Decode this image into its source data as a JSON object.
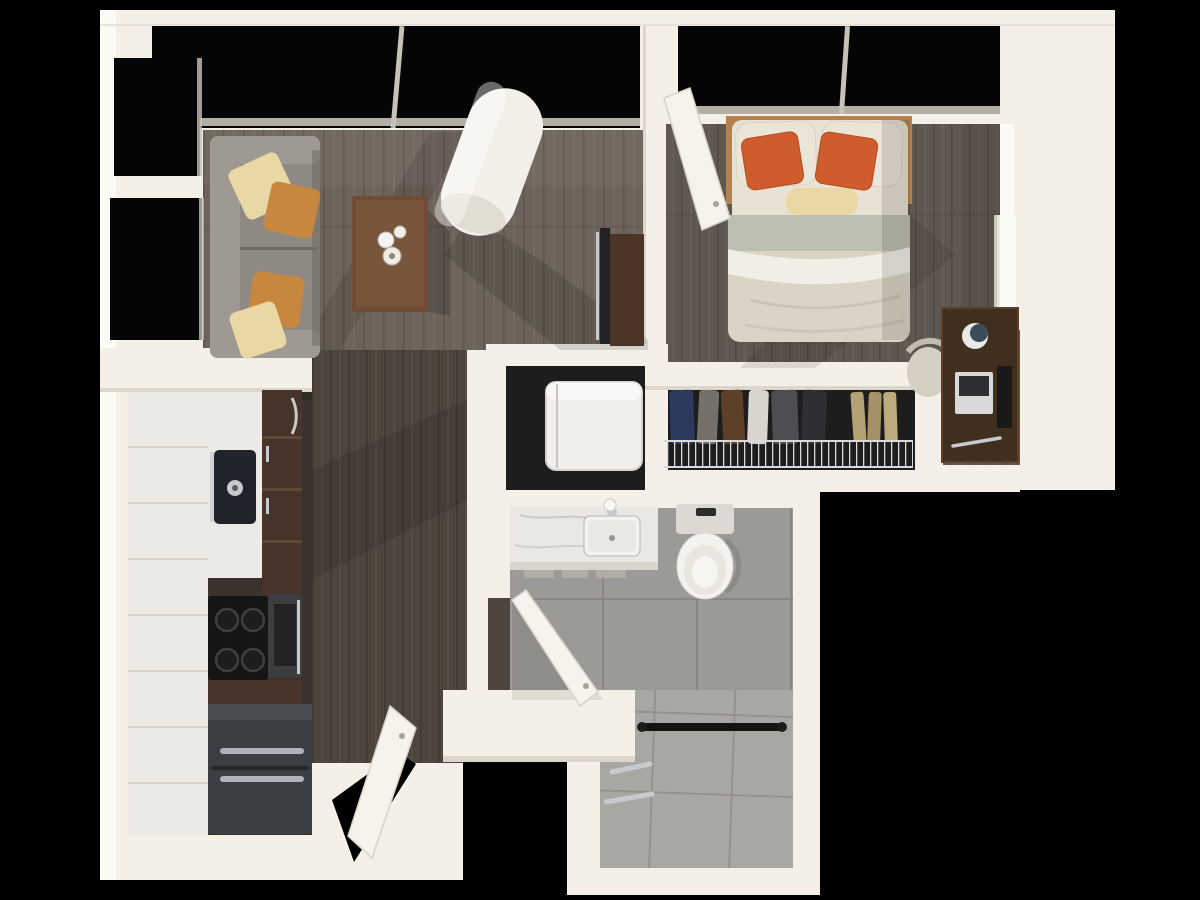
{
  "scene": {
    "width": 1200,
    "height": 900,
    "view": "top-down-3d-floor-plan"
  },
  "palette": {
    "bg": "#000000",
    "wall": "#f4f0e8",
    "wall_bright": "#fcfaf5",
    "wall_shade": "#ddd7cb",
    "frame_gray": "#c7c2b8",
    "glass": "#050505",
    "floor_living": "#6e635a",
    "floor_bedroom": "#5f5850",
    "floor_hall": "#4d443c",
    "floor_kitchen": "#3a332d",
    "tile_bath": "#9c9a96",
    "grout_bath": "#8a8781",
    "tile_shower": "#a9a7a2",
    "grout_shower": "#95928b",
    "counter": "#eceae4",
    "counter_seam": "#d5d1c7",
    "sofa": "#8e8982",
    "sofa_light": "#9e9992",
    "sofa_dark": "#6f6a63",
    "pillow_cream": "#e9d8a5",
    "pillow_tan": "#c8873f",
    "pillow_white": "#eae5d7",
    "pillow_orange": "#ce5c2c",
    "table_wood": "#6f4c33",
    "table_wood_light": "#836041",
    "column": "#f3f0e9",
    "column_shade": "#d9d4c9",
    "tv_console": "#4a3526",
    "tv_screen": "#222226",
    "bed_frame": "#b3824f",
    "bed_linen": "#e7e2d3",
    "bed_duvet": "#d9d4c4",
    "bed_sage": "#bcc0b0",
    "bed_white": "#f1eee5",
    "desk_wood": "#402e1f",
    "desk_edge": "#5a4128",
    "chair": "#d6d0c2",
    "laptop_body": "#d9d9d9",
    "laptop_screen": "#2d2f33",
    "closet_dark": "#1d1d1d",
    "wire": "#d9d9d9",
    "washer": "#f0efeb",
    "marble": "#eae8e3",
    "fixture": "#f3f2ee",
    "fixture_shade": "#dbd9d1",
    "towel": "#141414",
    "chrome": "#c6cacd",
    "cabinet": "#46342a",
    "cabinet_light": "#5f4936",
    "stove": "#151515",
    "oven": "#3d3d40",
    "fridge": "#3a3f44",
    "sink_dark": "#20242a",
    "door": "#f6f3ed",
    "door_edge": "#d8d3c9",
    "clothes_1": "#2c3a5e",
    "clothes_2": "#75706a",
    "clothes_3": "#5c4028",
    "clothes_4": "#d9d6cf",
    "clothes_5": "#4e4e52",
    "clothes_6": "#2f2f33",
    "clothes_7": "#b4a274",
    "clothes_8": "#a59166",
    "clothes_9": "#bcab7d"
  },
  "inventory": {
    "rooms": [
      {
        "id": "living-room"
      },
      {
        "id": "bedroom"
      },
      {
        "id": "walk-in-closet"
      },
      {
        "id": "laundry-closet"
      },
      {
        "id": "bathroom"
      },
      {
        "id": "kitchen"
      },
      {
        "id": "entry-hall"
      }
    ],
    "furniture": [
      "sofa",
      "throw-pillows",
      "coffee-table",
      "support-column",
      "tv-console",
      "bed",
      "desk",
      "desk-chair",
      "wire-shelf-with-clothes",
      "stacked-washer-dryer",
      "vanity-sink",
      "toilet",
      "walk-in-shower",
      "towel-bar",
      "grab-bars",
      "kitchen-counter",
      "kitchen-sink",
      "cooktop",
      "oven",
      "refrigerator",
      "entry-door",
      "bedroom-door",
      "bathroom-door",
      "windows"
    ]
  }
}
